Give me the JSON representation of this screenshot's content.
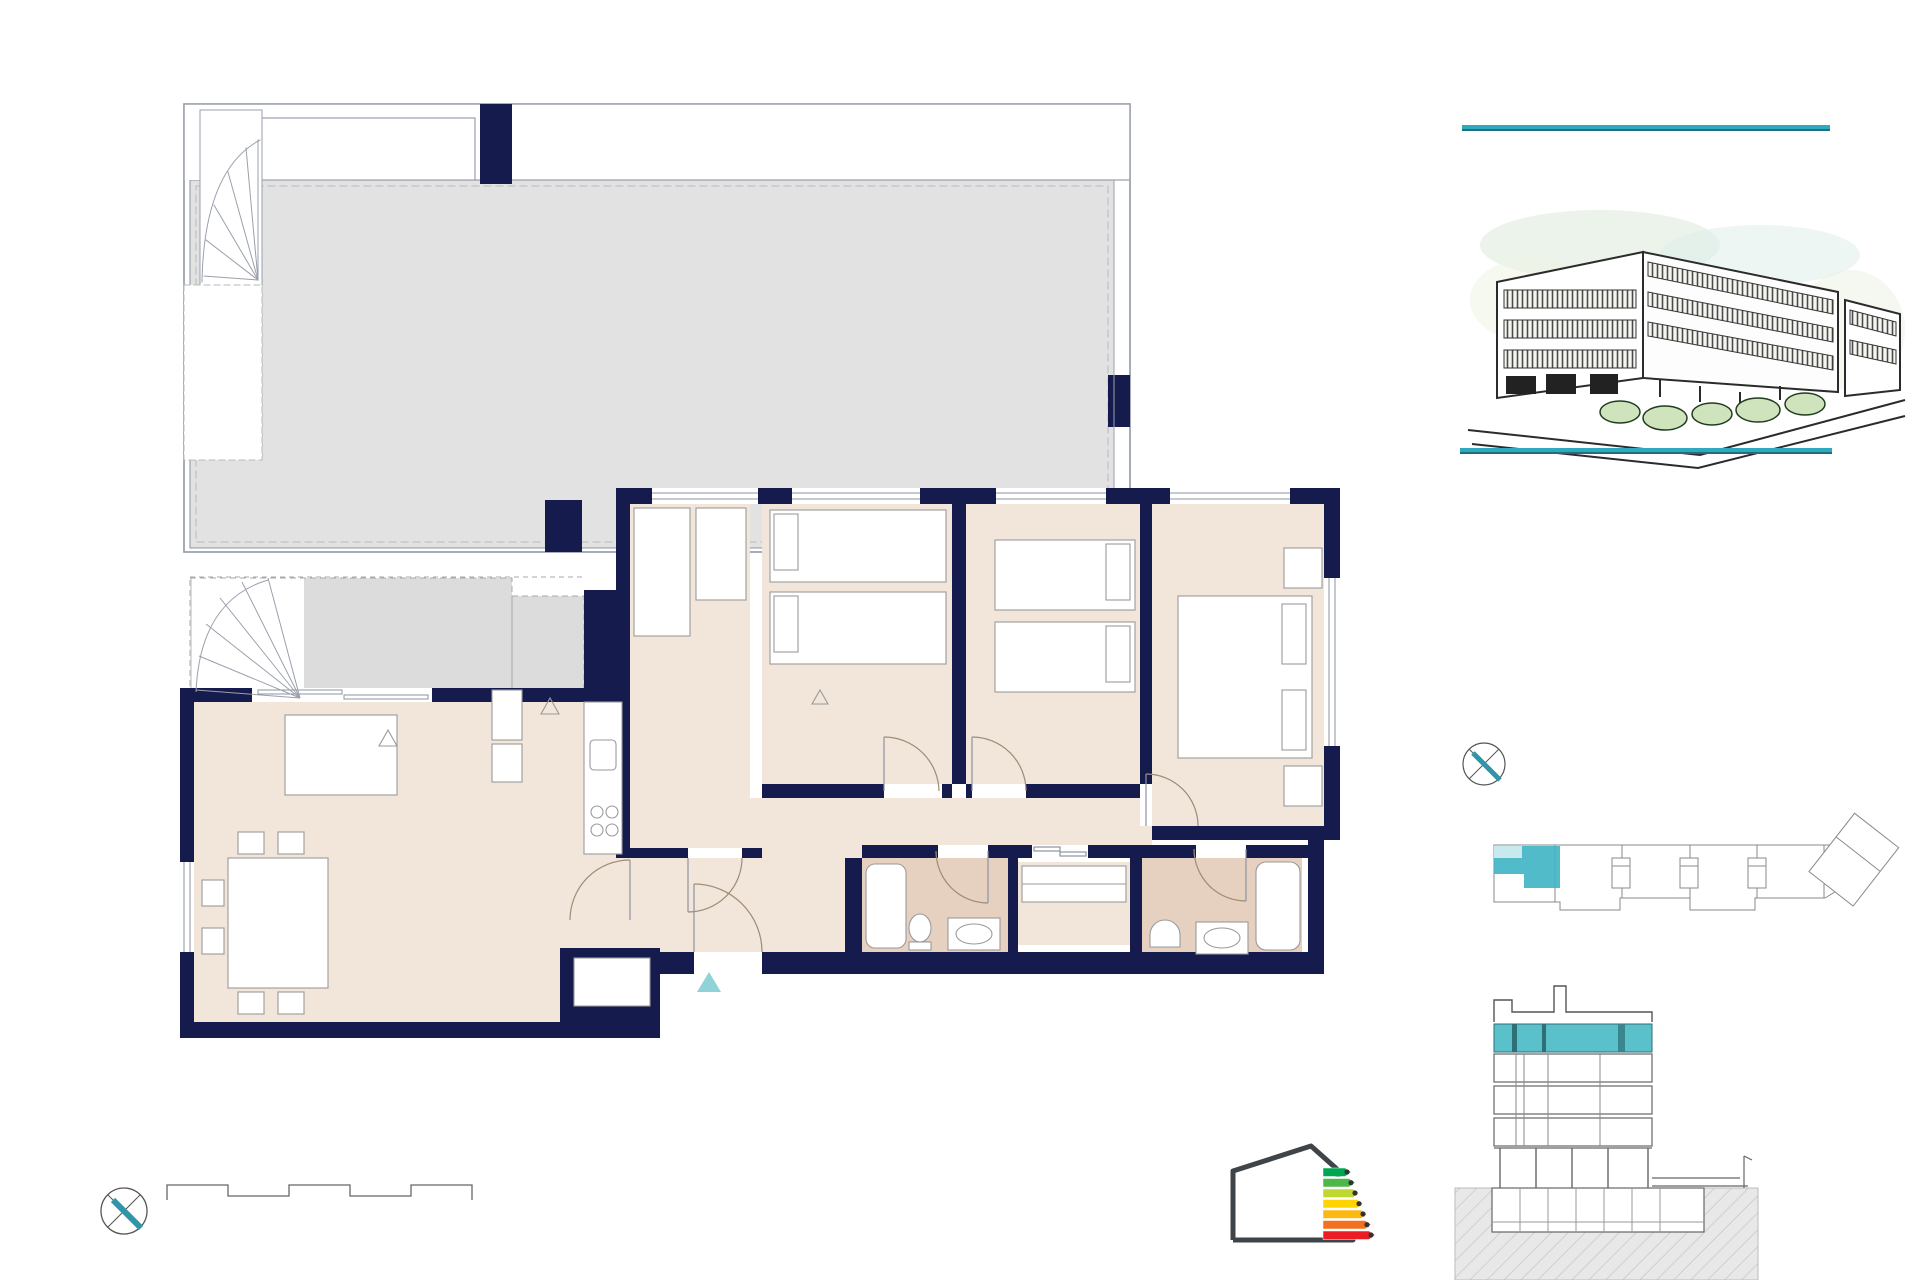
{
  "header": {
    "title": "Portal 1. P04 - C"
  },
  "roof_plan": {
    "room": {
      "name": "CUBIERTA PRIVADA",
      "area": "80.07 m²"
    }
  },
  "floor_plan": {
    "rooms": [
      {
        "name": "TERRAZA\nDESCUBIERTA",
        "area": "7.51 m²"
      },
      {
        "name": "TENDEDERO",
        "area": "1.17 m²"
      },
      {
        "name": "COCINA",
        "area": "5.27 m²"
      },
      {
        "name": "DORMITORIO 4",
        "area": "7.46 m²"
      },
      {
        "name": "DORMITORIO 3",
        "area": "9.00 m²"
      },
      {
        "name": "DORMITORIO 2",
        "area": "8.79 m²"
      },
      {
        "name": "DORMITORIO 1",
        "area": "11.68 m²"
      },
      {
        "name": "DISTRIBUIDOR",
        "area": "4.88 m²"
      },
      {
        "name": "SALÓN-COMEDOR",
        "area": "24.95 m²"
      },
      {
        "name": "VESTÍBULO",
        "area": "4.09 m²"
      },
      {
        "name": "BAÑO 2",
        "area": "3.86 m²"
      },
      {
        "name": "CLOSET",
        "area": "2.68 m²"
      },
      {
        "name": "BAÑO 1",
        "area": "3.76 m²"
      }
    ],
    "appliances": {
      "hm": "H+M",
      "nv": "NV",
      "lav": "LAV",
      "lv": "LV"
    },
    "entrance": {
      "letter": "C"
    }
  },
  "superficies": {
    "heading": "Superficies:",
    "unit_label": "Vivienda",
    "unit_code": "4d",
    "rows": [
      {
        "label": "Superficie útil interior",
        "value": "86,42m²"
      },
      {
        "label": "Superficie útil terrazas",
        "value": "88,75m²"
      },
      {
        "label": "Superficie construida interior",
        "value": "101,55m²"
      },
      {
        "label": "Superficie construida incluidas ZZCC",
        "value": "114,03m²"
      }
    ]
  },
  "compass": {
    "label": "N"
  },
  "scale_bar": {
    "title": "ESCALA GRÁFICA",
    "tick_start": "0",
    "tick_one": "1",
    "tick_end": "5 m"
  },
  "energy_label": {
    "energy_letter": "B",
    "emissions_letter": "A",
    "energy_caption": "Energía",
    "emissions_caption": "Emisiones",
    "status": "PROVISIONAL"
  },
  "watermark": {
    "line1": "verseas",
    "line2": "perty Ma"
  },
  "footer": {
    "disclaimer_line1": "El presente plano comercial, que incluye una parte gráfica y datos relativos a las superficies, puede ser objeto de modificaciones ordenadas por los organismos públicos competentes y/o exigencias técnicas o jurídicas,",
    "disclaimer_line2": "siempre y cuando estén justificados y no supongan alteraciones sustanciales. El mobiliario mostrado no está incluido y el equipamiento del inmueble será el indicado en la correspondiente memoria de calidades",
    "version": "V02"
  },
  "colors": {
    "accent_teal": "#2fa9bd",
    "accent_orange": "#f2a45c",
    "wall_navy": "#161b4d"
  }
}
